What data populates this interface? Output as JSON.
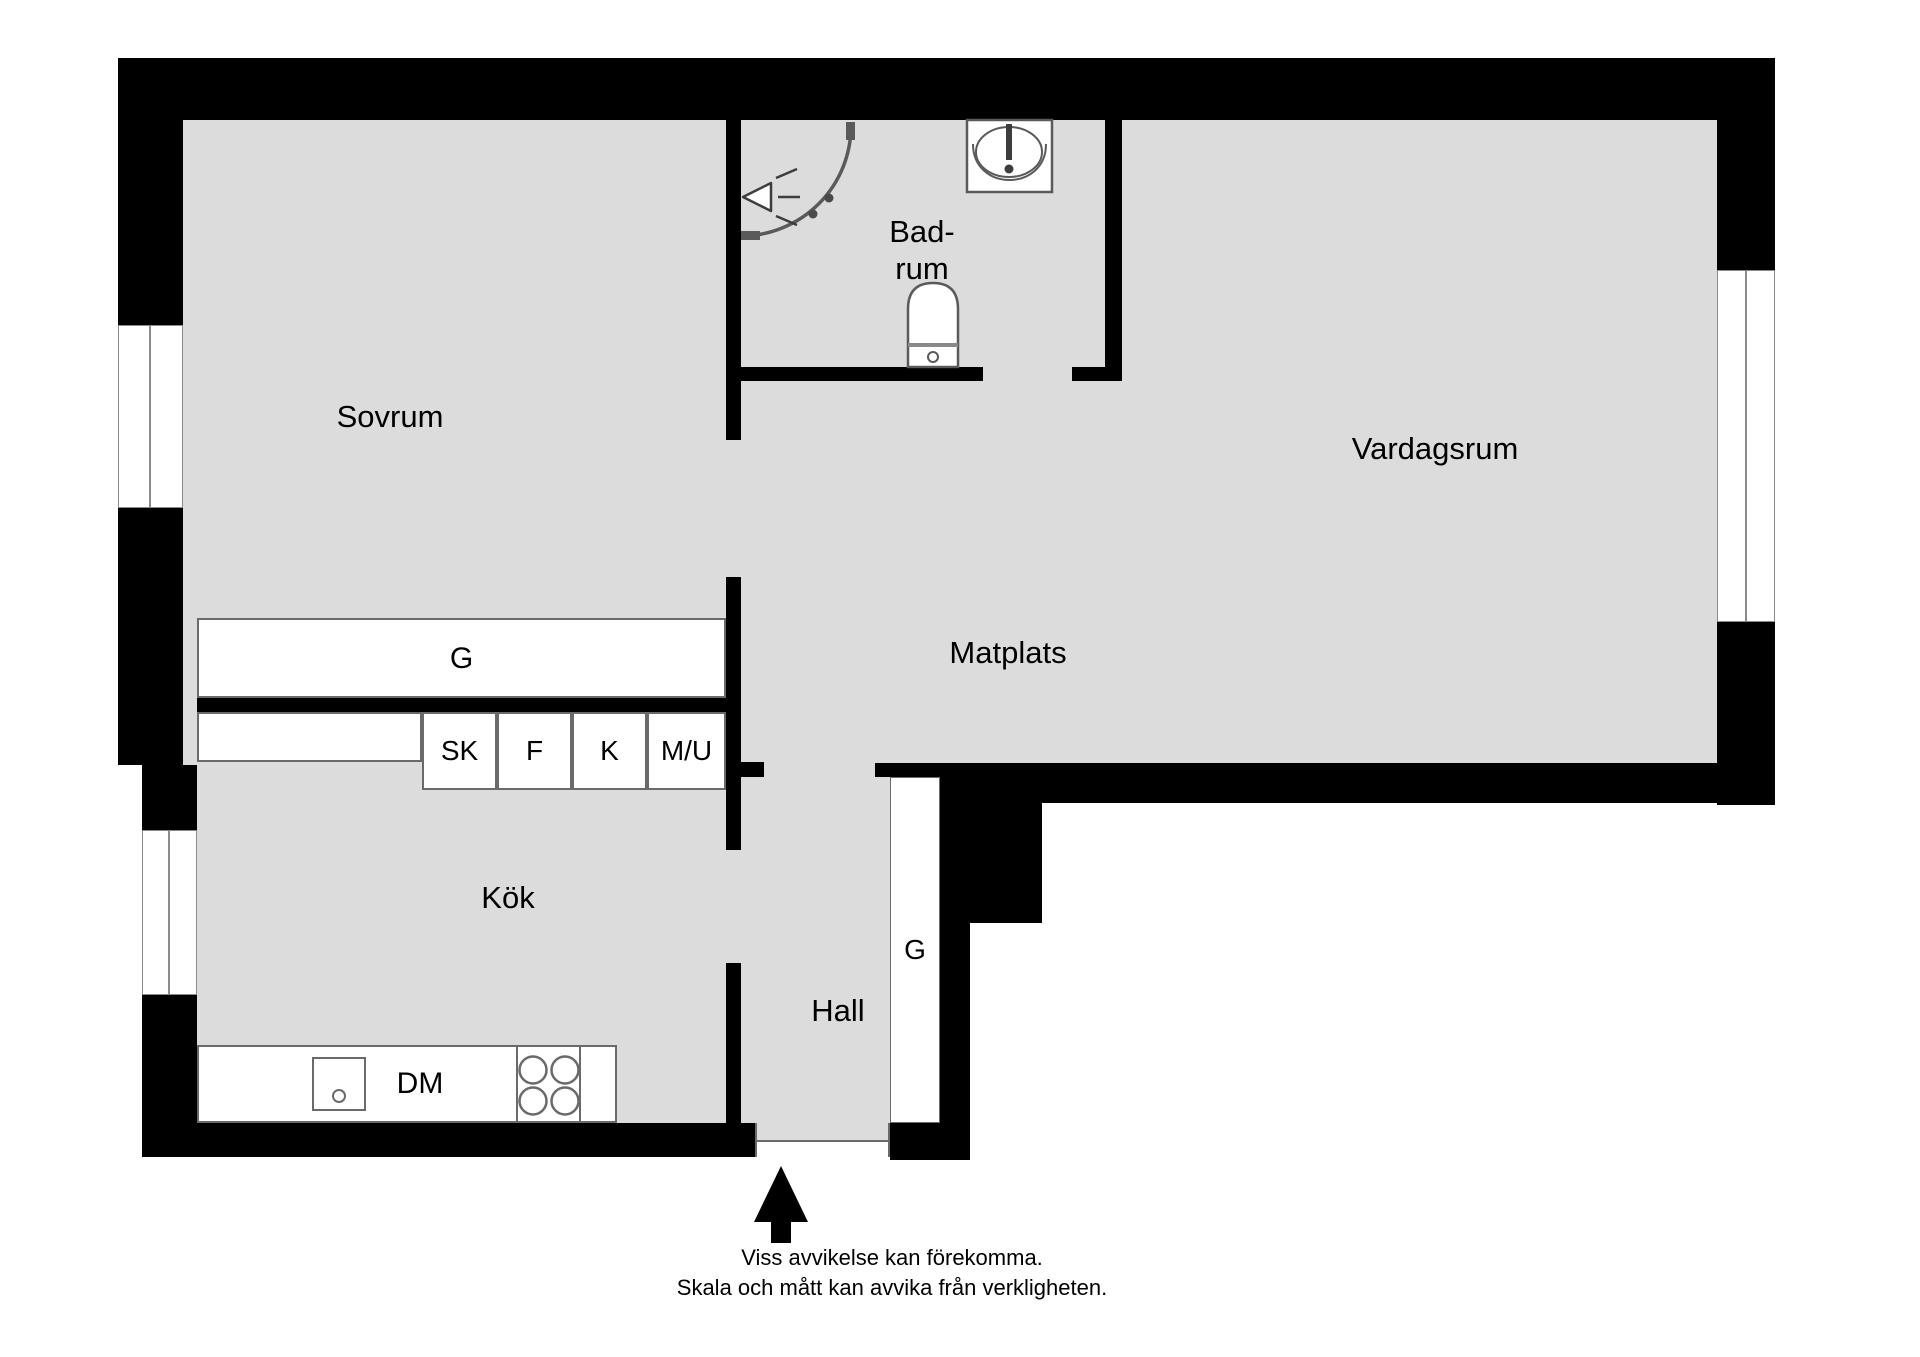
{
  "rooms": {
    "sovrum": {
      "label": "Sovrum"
    },
    "badrum": {
      "label_line1": "Bad-",
      "label_line2": "rum"
    },
    "vardagsrum": {
      "label": "Vardagsrum"
    },
    "matplats": {
      "label": "Matplats"
    },
    "kok": {
      "label": "Kök"
    },
    "hall": {
      "label": "Hall"
    }
  },
  "wardrobes": {
    "kitchen_row_label": "G",
    "hall_closet_label": "G"
  },
  "kitchen": {
    "cabinets": {
      "sk": "SK",
      "f": "F",
      "k": "K",
      "mu": "M/U",
      "dm": "DM"
    }
  },
  "icons": [
    "shower-icon",
    "washbasin-icon",
    "toilet-icon",
    "stove-icon",
    "kitchen-sink-icon",
    "entrance-arrow-icon",
    "window-icon"
  ],
  "disclaimer": {
    "line1": "Viss avvikelse kan förekomma.",
    "line2": "Skala och mått kan avvika från verkligheten."
  },
  "colors": {
    "wall": "#000000",
    "floor": "#dcdcdc",
    "fixture_line": "#6a6a6a",
    "text": "#000000",
    "background": "#ffffff"
  }
}
